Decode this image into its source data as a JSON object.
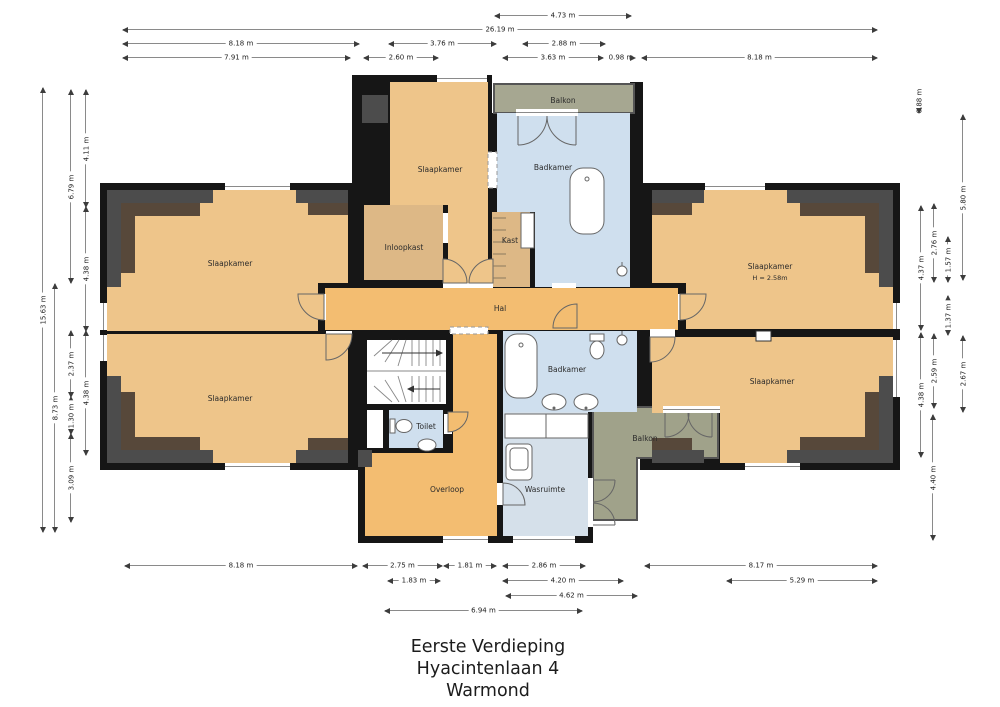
{
  "title": {
    "line1": "Eerste Verdieping",
    "line2": "Hyacintenlaan 4",
    "line3": "Warmond"
  },
  "rooms": {
    "slaapkamer_tl": "Slaapkamer",
    "slaapkamer_bl": "Slaapkamer",
    "slaapkamer_ct": "Slaapkamer",
    "slaapkamer_tr": "Slaapkamer",
    "slaapkamer_tr_height": "H = 2.58m",
    "slaapkamer_br": "Slaapkamer",
    "inloopkast": "Inloopkast",
    "kast": "Kast",
    "badkamer_top": "Badkamer",
    "badkamer_bottom": "Badkamer",
    "balkon_top": "Balkon",
    "balkon_bottom": "Balkon",
    "hal": "Hal",
    "toilet": "Toilet",
    "overloop": "Overloop",
    "wasruimte": "Wasruimte"
  },
  "dims": {
    "top": [
      "4.73 m",
      "26.19 m",
      "8.18 m",
      "3.76 m",
      "2.88 m",
      "7.91 m",
      "2.60 m",
      "3.63 m",
      "0.98 m",
      "8.18 m"
    ],
    "bottom": [
      "8.18 m",
      "2.75 m",
      "1.81 m",
      "2.86 m",
      "8.17 m",
      "1.83 m",
      "4.20 m",
      "5.29 m",
      "4.62 m",
      "6.94 m"
    ],
    "left": [
      "15.63 m",
      "8.73 m",
      "6.79 m",
      "2.37 m",
      "1.30 m",
      "3.09 m",
      "4.11 m",
      "4.38 m",
      "4.38 m"
    ],
    "right": [
      "0.88 m",
      "5.80 m",
      "2.76 m",
      "1.57 m",
      "4.37 m",
      "1.37 m",
      "2.59 m",
      "2.67 m",
      "4.38 m",
      "4.40 m"
    ]
  },
  "colors": {
    "wall": "#161616",
    "floor": "#eec58a",
    "hall": "#f3bd71",
    "closet": "#ddb886",
    "bath": "#cfdfee",
    "laundry": "#d5e0ea",
    "balcony": "#a6a791",
    "slope_gray": "#4c4c4c",
    "slope_brown": "#57483a"
  }
}
